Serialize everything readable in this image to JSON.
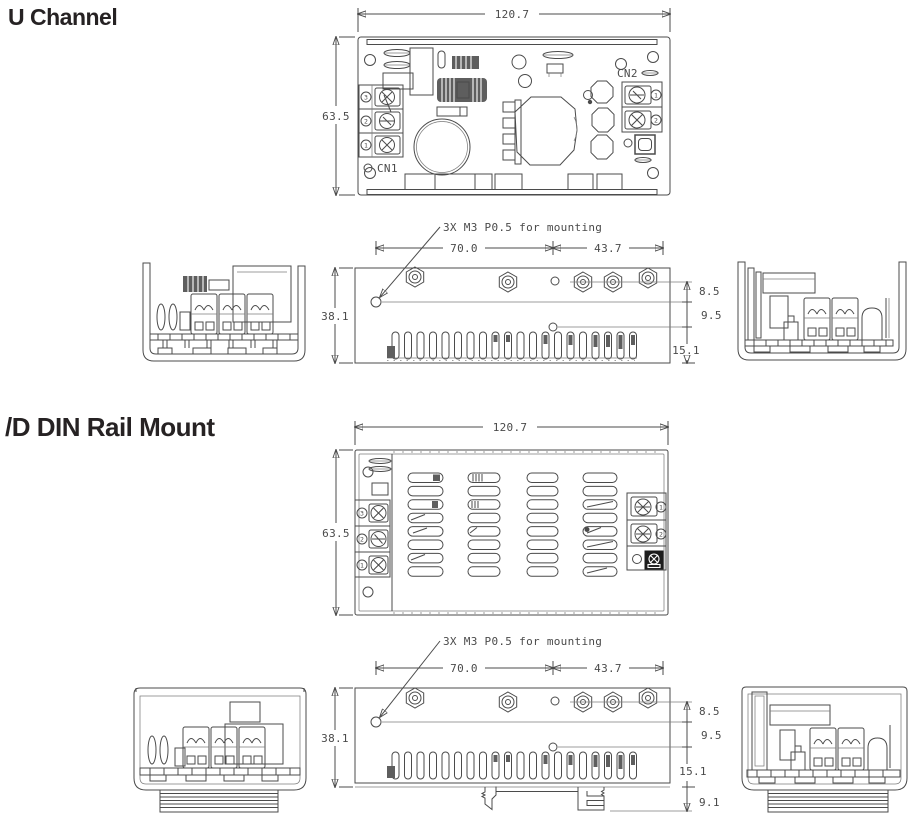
{
  "sections": [
    {
      "title": "U Channel"
    },
    {
      "title": "/D DIN Rail Mount"
    }
  ],
  "dims": {
    "overall_width": "120.7",
    "overall_height": "63.5",
    "body_depth": "38.1",
    "mount_span_left": "70.0",
    "mount_span_right": "43.7",
    "offset_top": "8.5",
    "offset_mid": "9.5",
    "vent_height": "15.1",
    "din_clip_depth": "9.1",
    "mounting_note": "3X M3 P0.5 for mounting"
  },
  "connectors": {
    "cn1_label": "CN1",
    "cn2_label": "CN2",
    "cn1_terminals": [
      "3",
      "2",
      "1"
    ],
    "cn2_terminals": [
      "1",
      "2"
    ]
  },
  "colors": {
    "line": "#4b4b4b",
    "text": "#4a4a4a",
    "heading": "#262223"
  }
}
